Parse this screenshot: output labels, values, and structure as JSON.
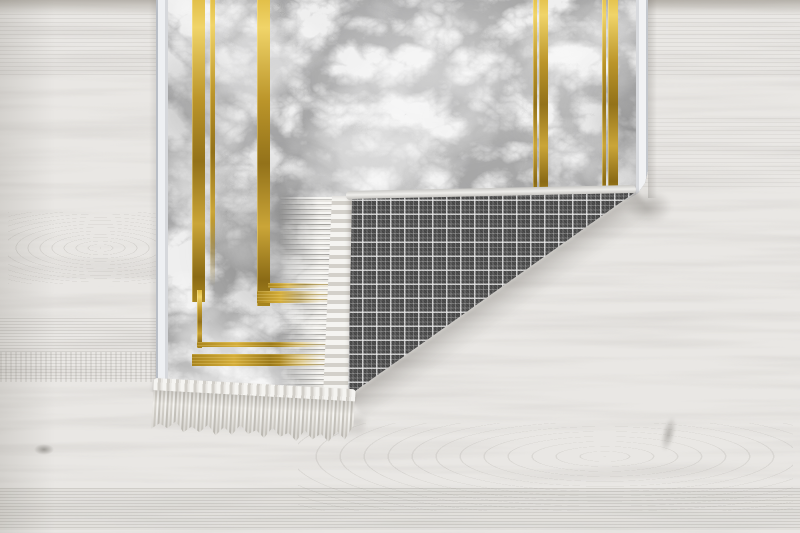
{
  "scene": {
    "type": "product-photo",
    "subject": "Gray marble-patterned area rug with gold accent lines; bottom-right corner folded over revealing a dark gray plaid woven backing and ivory fringe; lying on a whitewashed wood plank floor",
    "parts": {
      "floor": "whitewashed wood planks, horizontal grain with knots and arc figuring",
      "rug_face": "gray marble print with white veining and double gold pinstripe frame",
      "rug_backing": "dark gray windowpane plaid weave",
      "fringe": "ivory fringe tassels along the rug end",
      "edge_binding": "pale overlock binding on rug edges"
    },
    "colors": {
      "floor_base": "#e8e6e3",
      "floor_grain": "#b8b4ad",
      "marble_base": "#a9a9a9",
      "marble_vein": "#f6f6f6",
      "marble_shadow": "#6e6e6e",
      "gold": "#c79e2c",
      "gold_highlight": "#f0d469",
      "gold_dark": "#8a6a15",
      "plaid_base": "#484848",
      "plaid_line": "#ececec",
      "fringe": "#edebe6",
      "binding": "#eef0f3",
      "shadow": "#4e4a44"
    }
  }
}
